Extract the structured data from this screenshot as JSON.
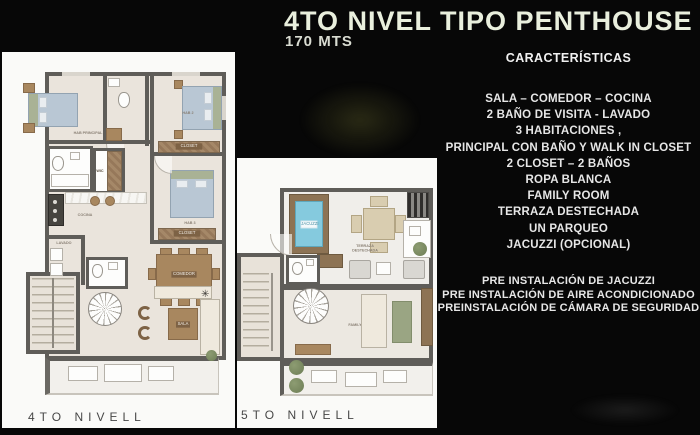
{
  "header": {
    "title": "4TO NIVEL TIPO PENTHOUSE",
    "subtitle": "170 MTS"
  },
  "characteristics": {
    "heading": "CARACTERÍSTICAS",
    "items": [
      "SALA – COMEDOR – COCINA",
      "2 BAÑO DE VISITA - LAVADO",
      "3 HABITACIONES ,",
      "PRINCIPAL CON BAÑO Y WALK IN CLOSET",
      "2 CLOSET – 2 BAÑOS",
      "ROPA BLANCA",
      "FAMILY ROOM",
      "TERRAZA DESTECHADA",
      "UN PARQUEO",
      "JACUZZI (OPCIONAL)"
    ],
    "pre_install": [
      "PRE INSTALACIÓN DE JACUZZI",
      "PRE INSTALACIÓN DE AIRE ACONDICIONADO",
      "PREINSTALACIÓN DE CÁMARA DE SEGURIDAD"
    ]
  },
  "plans": {
    "level4": {
      "caption": "4TO NIVELL",
      "rooms": {
        "hab_principal": "HAB PRINCIPAL",
        "hab2": "HAB 2",
        "hab3": "HAB 3",
        "closet": "CLOSET",
        "closet2": "CLOSET",
        "wic": "WIC",
        "cocina": "COCINA",
        "lavado": "LAVADO",
        "comedor": "COMEDOR",
        "sala": "SALA"
      }
    },
    "level5": {
      "caption": "5TO NIVELL",
      "rooms": {
        "jacuzzi": "JACUZZI",
        "terraza": "TERRAZA DESTECHADA",
        "family": "FAMILY"
      }
    }
  },
  "colors": {
    "background": "#070707",
    "title": "#e9efdd",
    "body_text": "#e6e6e6",
    "panel": "#fafaf8",
    "wall": "#5f5d59",
    "wood": "#a8875f",
    "bed": "#b9c7d4",
    "water": "#85cade",
    "caption_text": "#474747"
  }
}
